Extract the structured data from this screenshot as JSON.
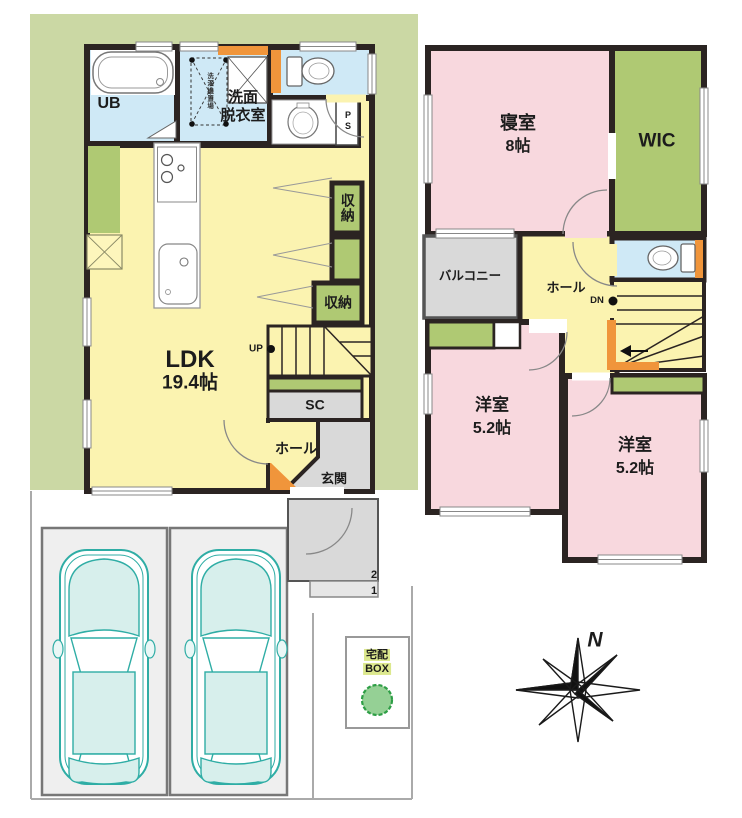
{
  "document_type": "floor-plan",
  "floor1": {
    "labels": {
      "ub": "UB",
      "washroom_l1": "洗面",
      "washroom_l2": "脱衣室",
      "washer_note": "洗濯機置場",
      "ps": "PS",
      "closet_upper": "収納",
      "closet_lower": "収納",
      "up": "UP",
      "ldk_name": "LDK",
      "ldk_area": "19.4帖",
      "sc": "SC",
      "hall": "ホール",
      "entrance": "玄関",
      "step_2": "2",
      "step_1": "1"
    },
    "rooms": [
      {
        "name": "LDK",
        "area": "19.4帖"
      },
      {
        "name": "UB"
      },
      {
        "name": "洗面脱衣室"
      },
      {
        "name": "収納"
      },
      {
        "name": "収納"
      },
      {
        "name": "SC"
      },
      {
        "name": "ホール"
      },
      {
        "name": "玄関"
      }
    ]
  },
  "floor2": {
    "labels": {
      "bedroom_name": "寝室",
      "bedroom_area": "8帖",
      "wic": "WIC",
      "balcony": "バルコニー",
      "hall": "ホール",
      "dn": "DN",
      "west1_name": "洋室",
      "west1_area": "5.2帖",
      "west2_name": "洋室",
      "west2_area": "5.2帖"
    },
    "rooms": [
      {
        "name": "寝室",
        "area": "8帖"
      },
      {
        "name": "WIC"
      },
      {
        "name": "バルコニー"
      },
      {
        "name": "ホール"
      },
      {
        "name": "洋室",
        "area": "5.2帖"
      },
      {
        "name": "洋室",
        "area": "5.2帖"
      }
    ]
  },
  "exterior": {
    "delivery_l1": "宅配",
    "delivery_l2": "BOX",
    "north": "N",
    "parking_spaces": 2
  },
  "colors": {
    "room_yellow": "#FBF3B0",
    "room_pink": "#F8D8DE",
    "room_blue": "#CFE9F6",
    "closet_green": "#AFC973",
    "site_green": "#CBD8A4",
    "gray_area": "#D9D9D9",
    "accent_orange": "#F0953B",
    "wall": "#2B2422",
    "car_teal": "#2FADA5",
    "highlight": "#DCE88E"
  }
}
